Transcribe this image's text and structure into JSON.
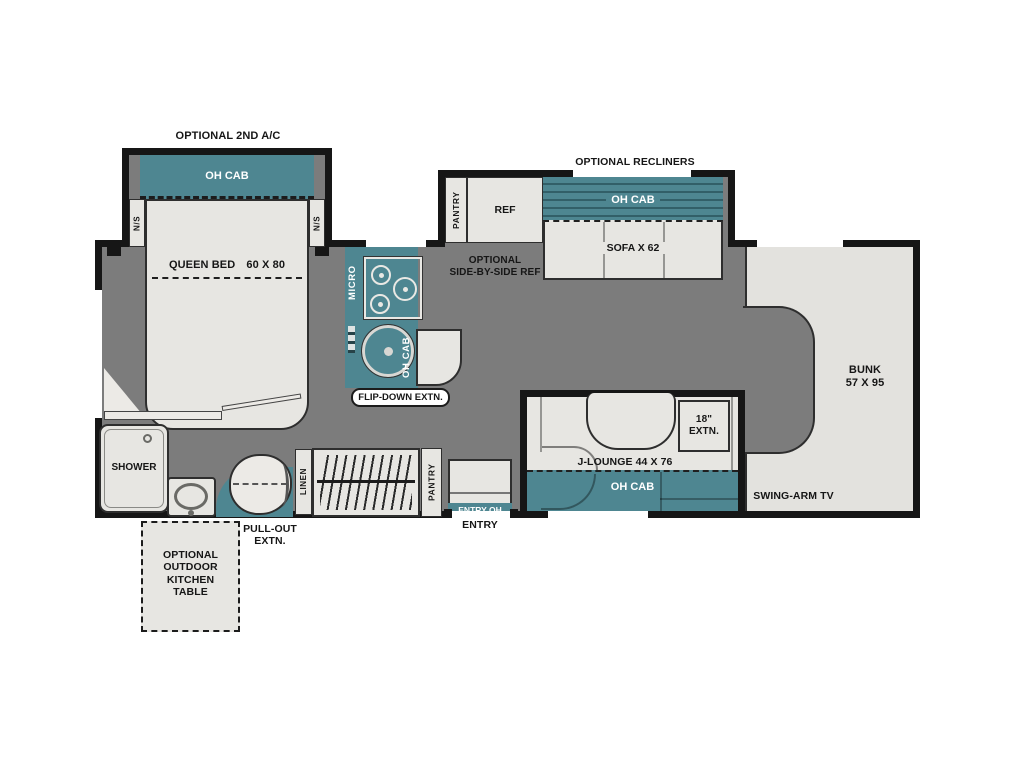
{
  "plan": {
    "colors": {
      "cabinet_teal": "#4e8691",
      "floor_gray": "#7c7c7c",
      "furniture_light": "#e7e6e2",
      "wall_dark": "#161616",
      "bunk_light": "#e3e2de"
    },
    "bedroom": {
      "optional_ac_label": "OPTIONAL 2ND A/C",
      "oh_cab_label": "OH CAB",
      "nightstand_left": "N/S",
      "nightstand_right": "N/S",
      "bed_name": "QUEEN BED",
      "bed_size": "60 X 80"
    },
    "kitchen": {
      "micro_label": "MICRO",
      "oh_cab_label": "OH CAB",
      "flip_down_label": "FLIP-DOWN EXTN."
    },
    "galley_slide": {
      "recliners_label": "OPTIONAL RECLINERS",
      "pantry_label": "PANTRY",
      "ref_label": "REF",
      "optional_ref_line1": "OPTIONAL",
      "optional_ref_line2": "SIDE-BY-SIDE REF",
      "oh_cab_label": "OH CAB",
      "sofa_label": "SOFA X 62"
    },
    "bunk": {
      "name": "BUNK",
      "size": "57 X 95",
      "tv_label": "SWING-ARM TV"
    },
    "j_lounge": {
      "extn_line1": "18\"",
      "extn_line2": "EXTN.",
      "label": "J-LOUNGE 44 X 76",
      "oh_cab_label": "OH CAB"
    },
    "bath": {
      "shower_label": "SHOWER",
      "linen_label": "LINEN",
      "pantry_label": "PANTRY",
      "pull_out_line1": "PULL-OUT",
      "pull_out_line2": "EXTN."
    },
    "entry": {
      "oh_cab_label": "ENTRY OH",
      "door_label": "ENTRY"
    },
    "outdoor_table": {
      "line1": "OPTIONAL",
      "line2": "OUTDOOR",
      "line3": "KITCHEN",
      "line4": "TABLE"
    }
  }
}
